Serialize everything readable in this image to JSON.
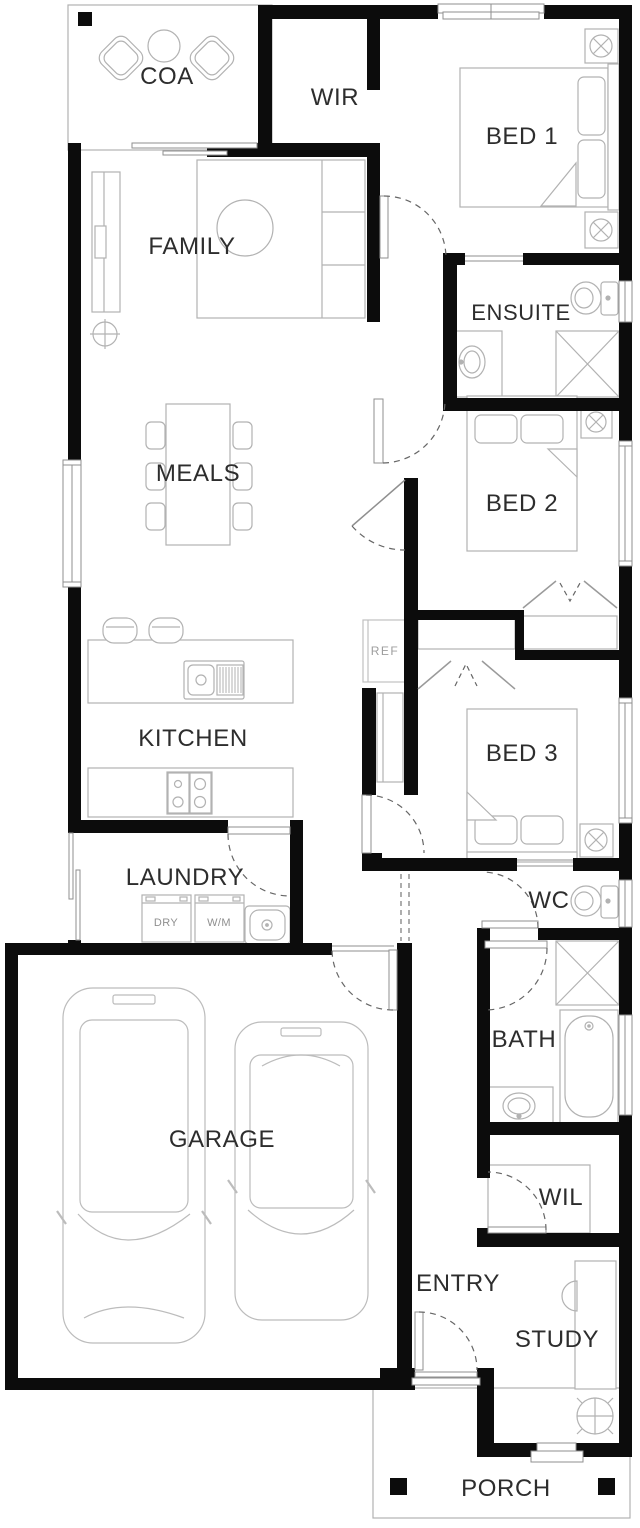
{
  "plan": {
    "colors": {
      "wall": "#0c0c0c",
      "furniture_line": "#b2b2b2",
      "frame_line": "#8f8f8f",
      "door_dash": "#666666",
      "label": "#2d2d2d",
      "label_small": "#9d9d9d"
    },
    "rooms": {
      "coa": {
        "label": "COA"
      },
      "wir": {
        "label": "WIR"
      },
      "bed1": {
        "label": "BED 1"
      },
      "family": {
        "label": "FAMILY"
      },
      "ensuite": {
        "label": "ENSUITE"
      },
      "meals": {
        "label": "MEALS"
      },
      "bed2": {
        "label": "BED 2"
      },
      "kitchen": {
        "label": "KITCHEN"
      },
      "bed3": {
        "label": "BED 3"
      },
      "laundry": {
        "label": "LAUNDRY"
      },
      "wc": {
        "label": "WC"
      },
      "garage": {
        "label": "GARAGE"
      },
      "bath": {
        "label": "BATH"
      },
      "wil": {
        "label": "WIL"
      },
      "entry": {
        "label": "ENTRY"
      },
      "study": {
        "label": "STUDY"
      },
      "porch": {
        "label": "PORCH"
      }
    },
    "appliances": {
      "ref": {
        "label": "REF"
      },
      "dryer": {
        "label": "DRY"
      },
      "washer": {
        "label": "W/M"
      }
    }
  }
}
